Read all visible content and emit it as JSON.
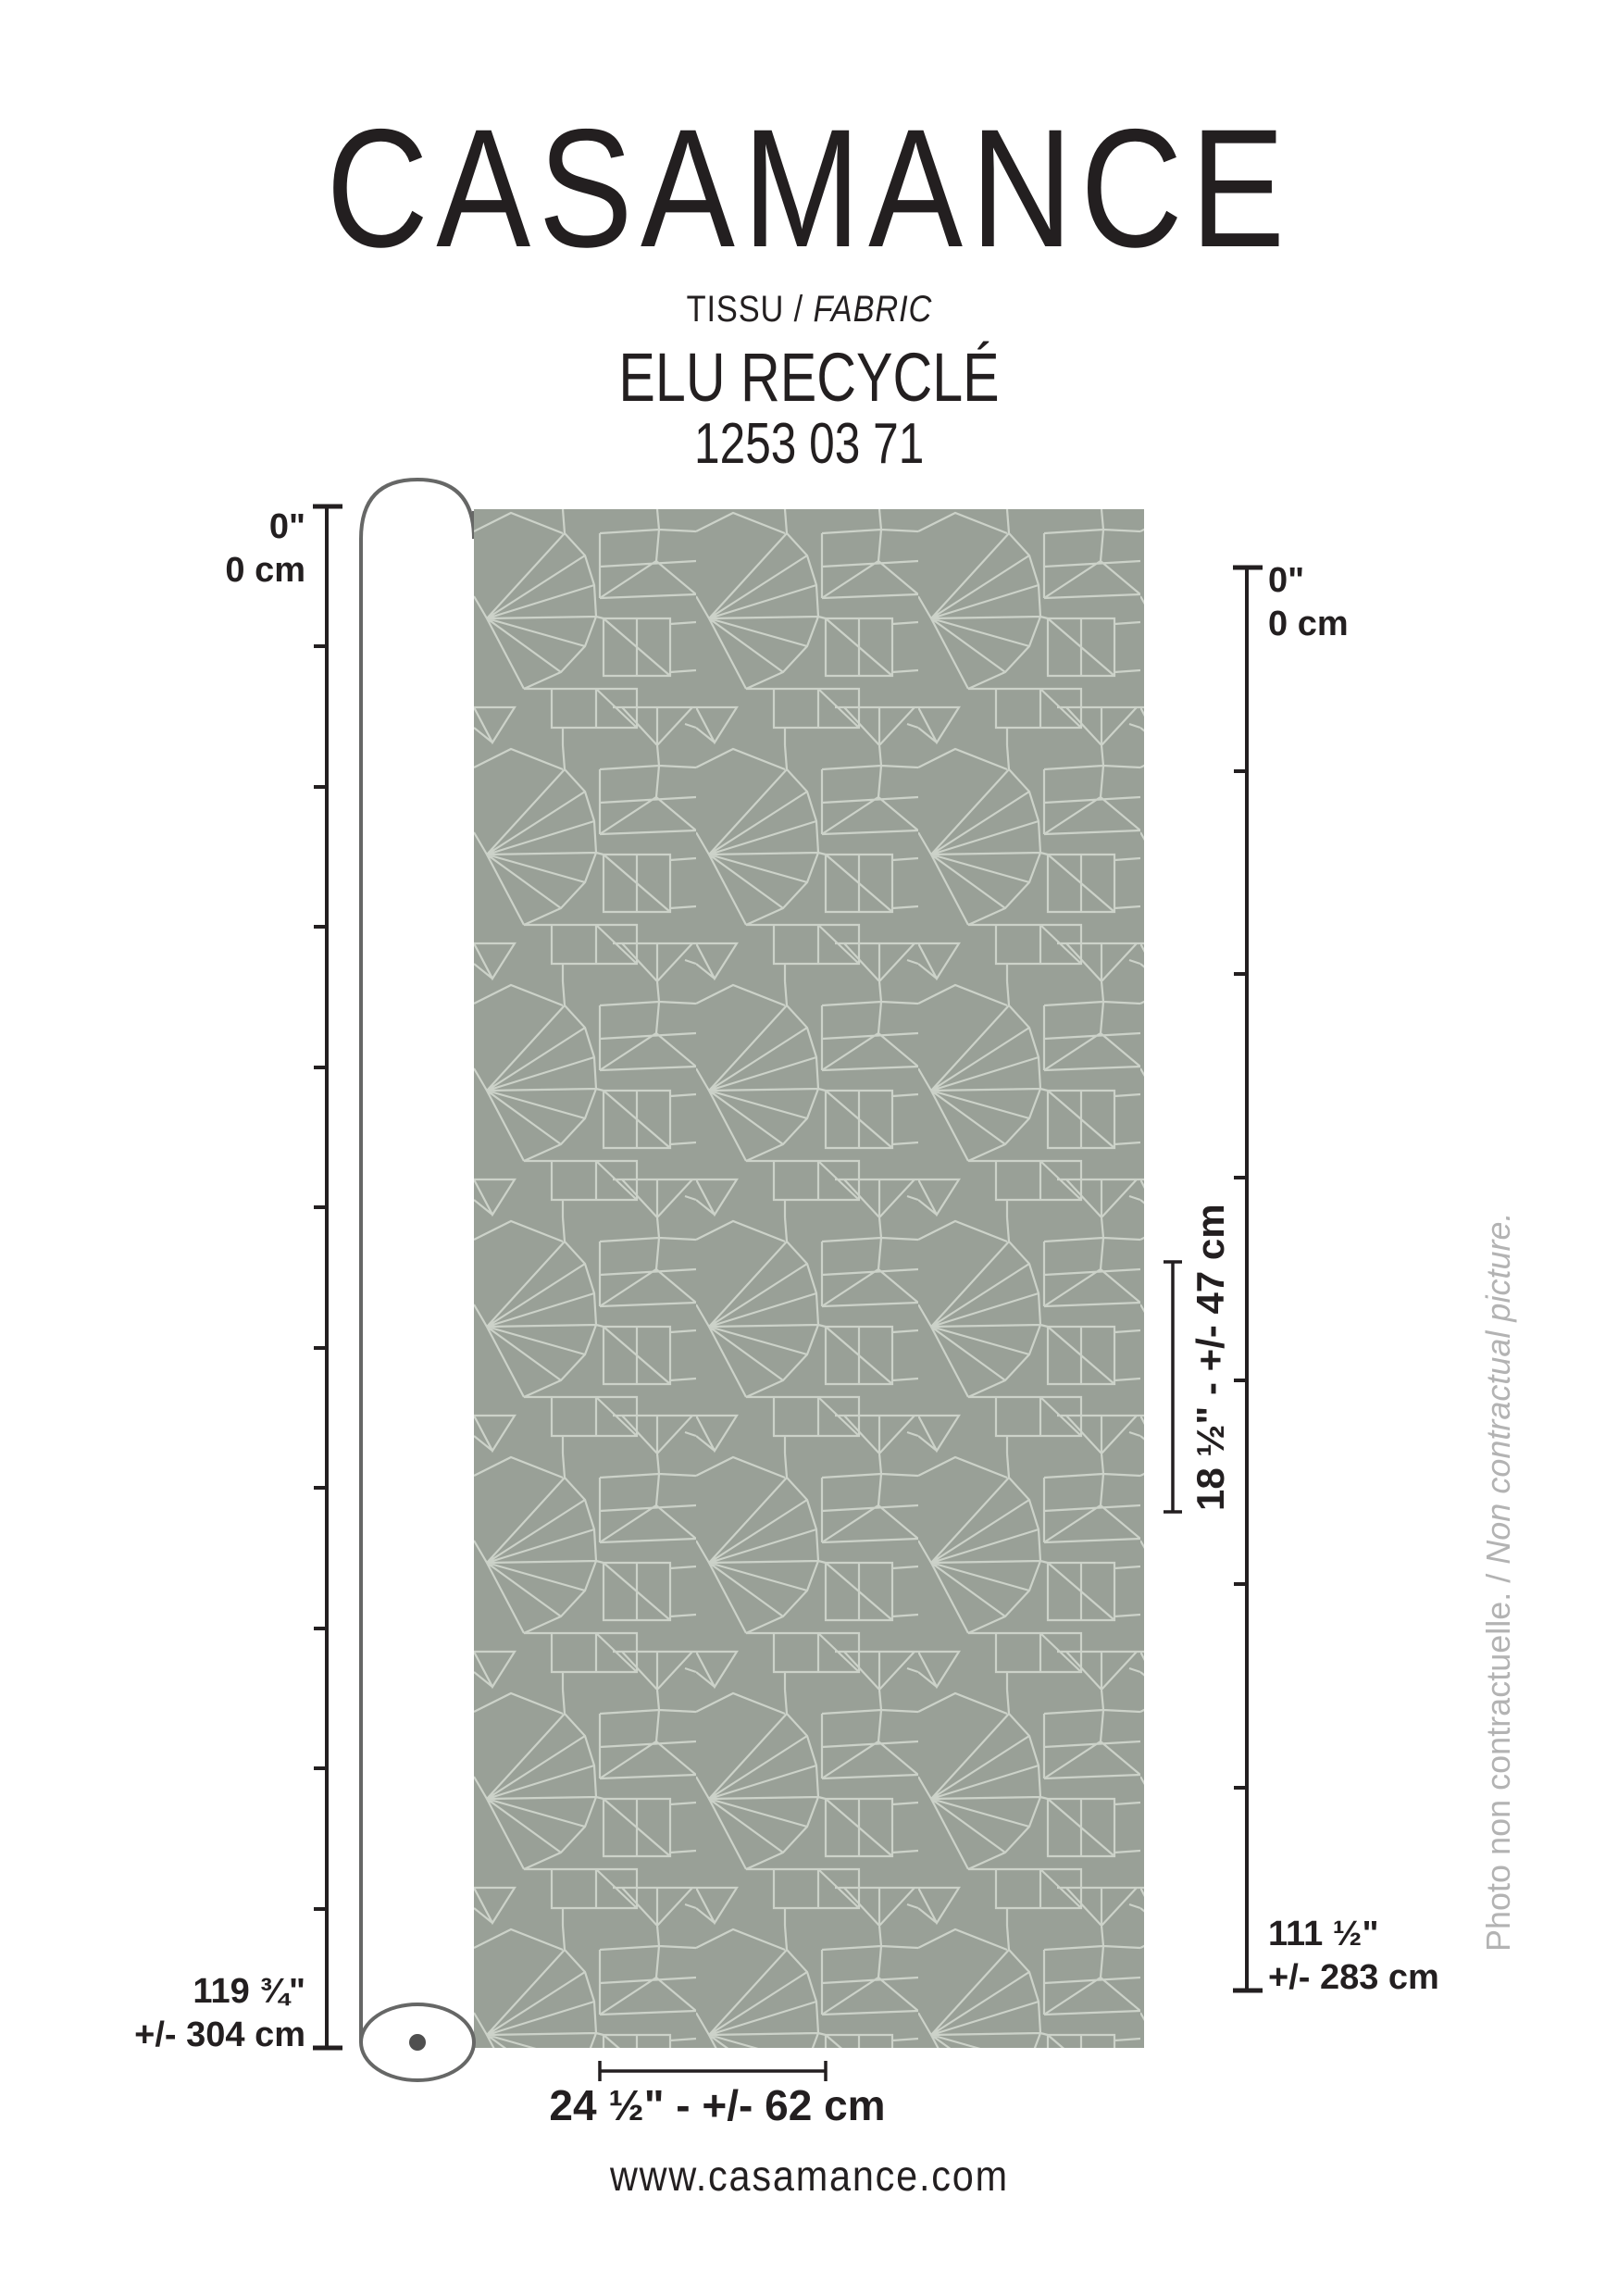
{
  "brand": "CASAMANCE",
  "header": {
    "category_fr": "TISSU",
    "category_sep": " / ",
    "category_en": "FABRIC",
    "product_name": "ELU RECYCLÉ",
    "product_code": "1253 03 71"
  },
  "left_ruler": {
    "top_inches": "0\"",
    "top_cm": "0 cm",
    "bottom_inches": "119 ¾\"",
    "bottom_cm": "+/- 304 cm"
  },
  "right_ruler": {
    "top_inches": "0\"",
    "top_cm": "0 cm",
    "bottom_inches": "111 ½\"",
    "bottom_cm": "+/- 283 cm"
  },
  "measurements": {
    "vertical_repeat": "18 ½\" - +/- 47 cm",
    "width": "24 ½\" - +/- 62 cm"
  },
  "footer": {
    "website": "www.casamance.com"
  },
  "disclaimer": {
    "fr": "Photo non contractuelle.",
    "sep": " / ",
    "en": "Non contractual picture."
  },
  "colors": {
    "fabric_bg": "#99a097",
    "fabric_line": "#ccd2c9",
    "ink": "#231f20",
    "roll_outline": "#666766",
    "roll_dot": "#4f4f4f",
    "note_gray": "#b3b3b3",
    "paper": "#ffffff"
  }
}
